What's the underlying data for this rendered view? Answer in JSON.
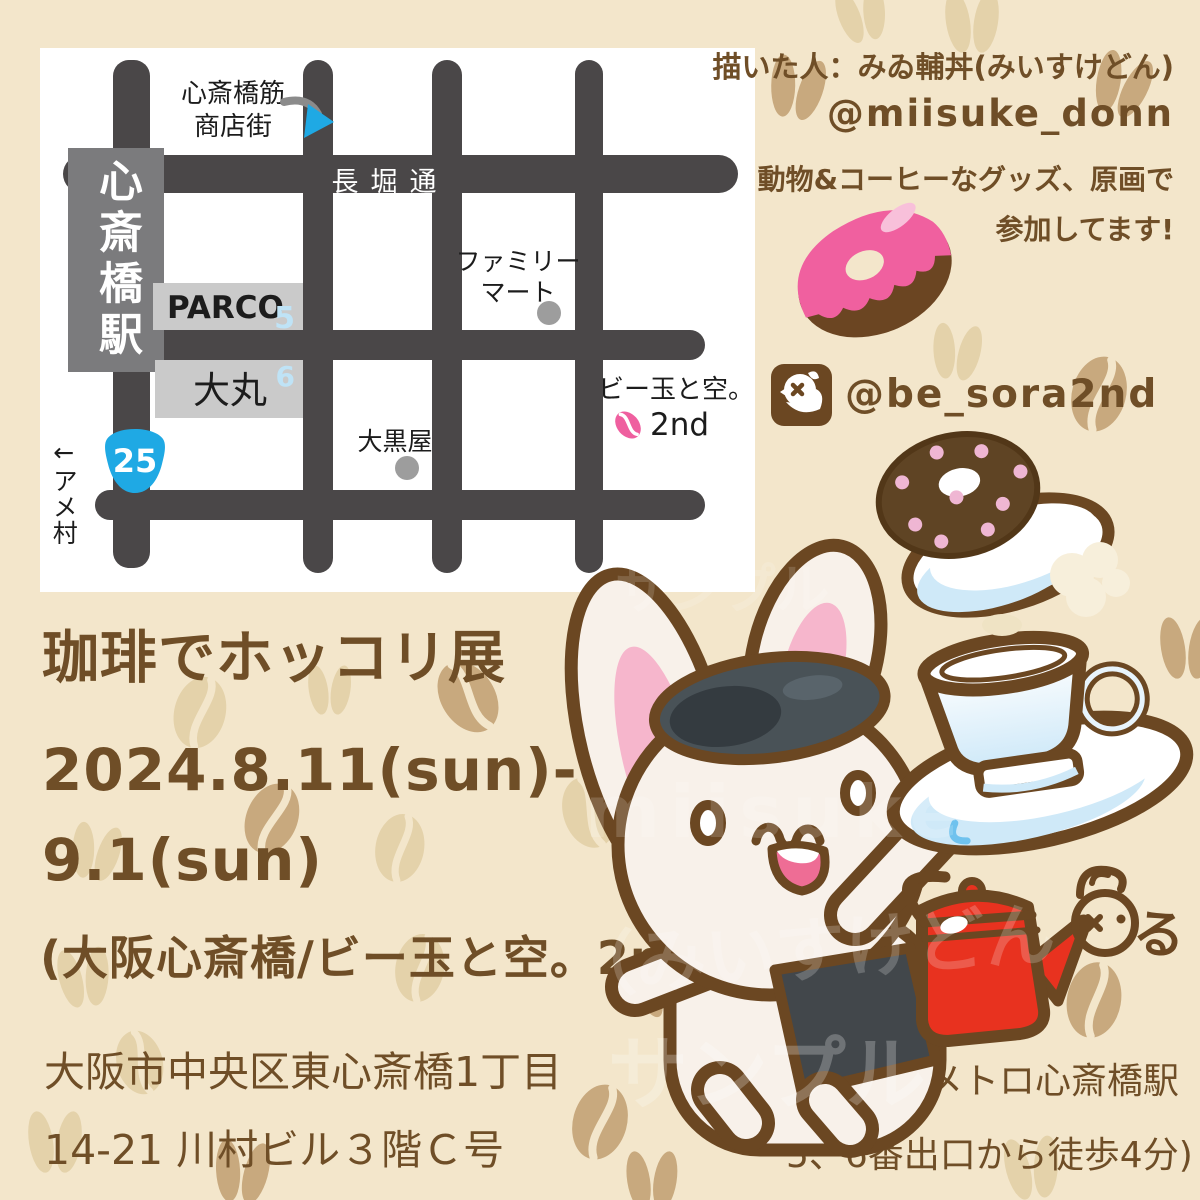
{
  "artist_credit": {
    "line1": "描いた人：みゐ輔丼(みいすけどん)",
    "handle": "@miisuke_donn",
    "line2": "動物&コーヒーなグッズ、原画で",
    "line3": "参加してます!",
    "signature_mark": "る"
  },
  "shop_account": {
    "handle": "@be_sora2nd",
    "icon": "bird-icon"
  },
  "event": {
    "title": "珈琲でホッコリ展",
    "date_line1": "2024.8.11(sun)-",
    "date_line2": "9.1(sun)",
    "venue_line": "(大阪心斎橋/ビー玉と空。2nd)",
    "address_line1": "大阪市中央区東心斎橋1丁目",
    "address_line2": "14-21 川村ビル３階Ｃ号",
    "access_line1": "(メトロ心斎橋駅",
    "access_line2": "5、6番出口から徒歩4分)"
  },
  "map": {
    "station_sign": "心斎橋駅",
    "main_street": "長堀通",
    "shopping_street_line1": "心斎橋筋",
    "shopping_street_line2": "商店街",
    "parco": {
      "name": "PARCO",
      "exit_no": "5"
    },
    "daimaru": {
      "name": "大丸",
      "exit_no": "6"
    },
    "familymart_line1": "ファミリー",
    "familymart_line2": "マート",
    "daikokuya": "大黒屋",
    "destination_line1": "ビー玉と空。",
    "destination_line2": "2nd",
    "route_number": "25",
    "amemura_note": "←アメ村"
  },
  "watermarks": {
    "wm1": "miisuke",
    "wm2": "（みいすけどん",
    "wm3": "サンプル",
    "wm4": "サンプル"
  },
  "colors": {
    "background": "#f3e6cb",
    "text_brown": "#6f4e27",
    "outline_brown": "#6b4722",
    "map_road": "#4a4748",
    "station_gray": "#7b7b7d",
    "building_gray": "#cacaca",
    "accent_blue": "#1fa9e4",
    "pale_blue": "#bfe3f6",
    "donut_pink": "#f0609f",
    "kettle_red": "#e8321f",
    "bean_dark": "#c8a97e",
    "bean_light": "#e4d2aa"
  }
}
